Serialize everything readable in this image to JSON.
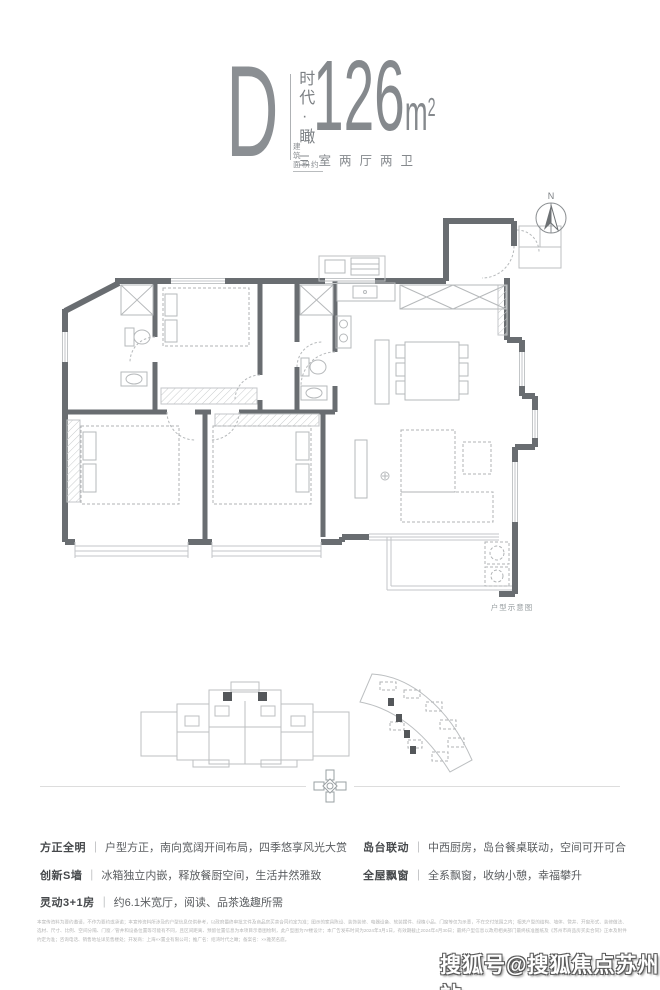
{
  "header": {
    "plan_letter": "D",
    "series_name_vertical": "时代·瞰",
    "area_label_line1": "建筑",
    "area_label_line2": "面积约",
    "area_value": "126",
    "area_unit": "m",
    "area_unit_exponent": "2",
    "rooms_summary": "三室两厅两卫"
  },
  "floorplan": {
    "compass_label": "N",
    "caption": "户型示意图"
  },
  "features": {
    "separator": "｜",
    "left": [
      {
        "title": "方正全明",
        "desc": "户型方正，南向宽阔开间布局，四季悠享风光大赏"
      },
      {
        "title": "创新S墙",
        "desc": "冰箱独立内嵌，释放餐厨空间，生活井然雅致"
      },
      {
        "title": "灵动3+1房",
        "desc": "约6.1米宽厅，阅读、品茶逸趣所需"
      }
    ],
    "right": [
      {
        "title": "岛台联动",
        "desc": "中西厨房，岛台餐桌联动，空间可开可合"
      },
      {
        "title": "全屋飘窗",
        "desc": "全系飘窗，收纳小憩，幸福攀升"
      }
    ]
  },
  "disclaimer": "本宣传资料为要约邀请，不作为要约或承诺；本宣传资料所涉及的户型信息仅供参考，以政府最终审批文件及商品房买卖合同约定为准；图示的家具陈设、装饰装修、电器设备、软装摆件、绿植小品、门窗等仅为示意，不在交付范围之内；相关户型的结构、墙体、管井、开窗形式、装修做法、选材、尺寸、比例、空间分隔、门窗／管井和设备位置等可能有不同，且区间距离、预留位置信息为本项目示意图绘制，此户型图为7#楼设计；本广告发布时间为2024年3月1日，有效期截止2024年4月30日；最终户型信息以政府相关部门最终核准图纸及《苏州市商品房买卖合同》正本及附件约定为准；咨询电话、销售地址详见售楼处；开发商：上海××置业有限公司；推广名：绍湾时代之瞰；备案名：××雅苑名庭。",
  "watermark": "搜狐号@搜狐焦点苏州站",
  "colors": {
    "wall": "#696d71",
    "thin_line": "#c3c6c8",
    "accent_text": "#85898d"
  }
}
